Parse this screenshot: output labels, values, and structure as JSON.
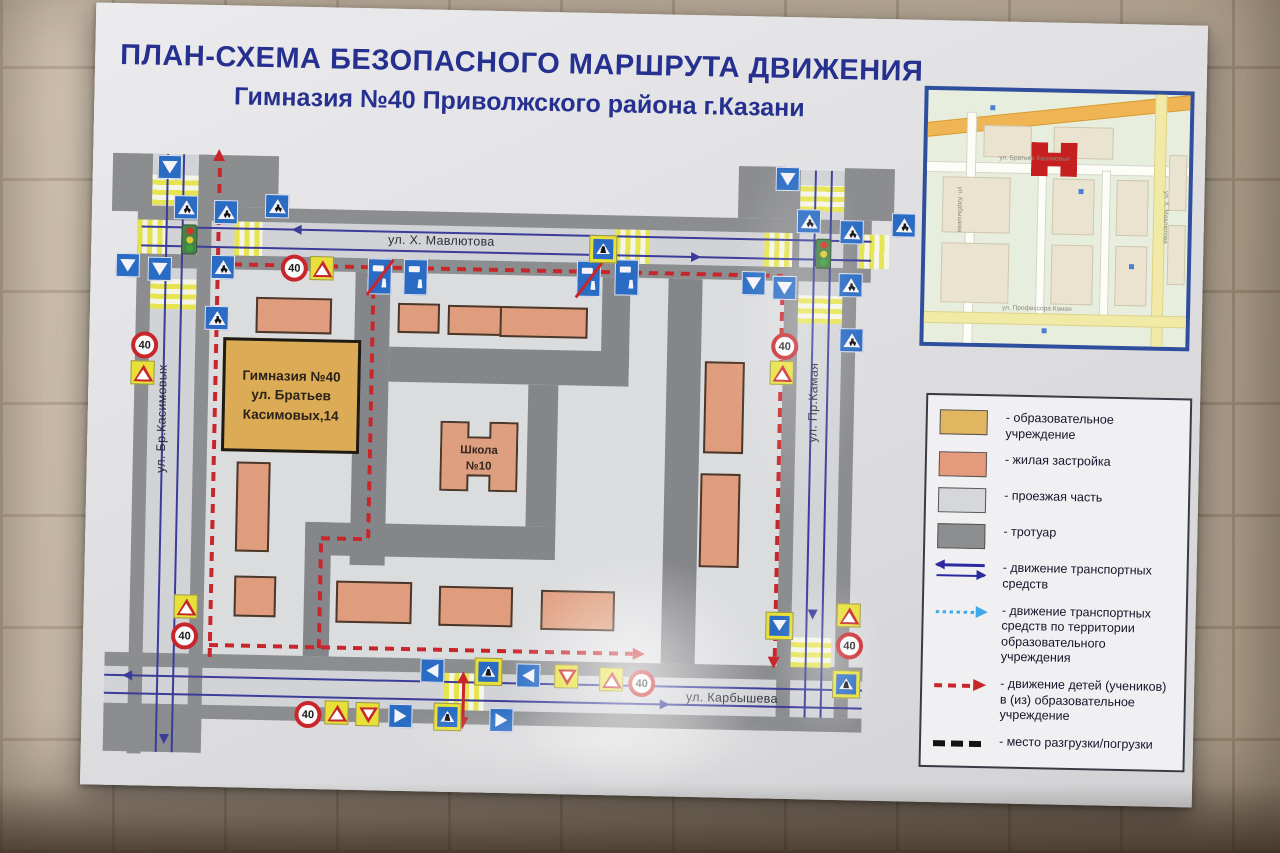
{
  "title": {
    "line1": "ПЛАН-СХЕМА БЕЗОПАСНОГО МАРШРУТА ДВИЖЕНИЯ",
    "line2": "Гимназия №40 Приволжского района г.Казани"
  },
  "streets": {
    "top": "ул. Х. Мавлютова",
    "left": "ул. Бр.Касимовых",
    "right": "ул. Пр.Камая",
    "bottom": "ул. Карбышева"
  },
  "buildings": {
    "gymnasium": {
      "line1": "Гимназия №40",
      "line2": "ул. Братьев",
      "line3": "Касимовых,14"
    },
    "school": {
      "line1": "Школа",
      "line2": "№10"
    }
  },
  "signs": {
    "speed_limit": "40"
  },
  "inset": {
    "street_top": "ул. Братьев Касимовых",
    "street_bottom": "ул. Профессора Камая",
    "street_left": "ул. Карбышева",
    "street_right": "ул. Х. Мавлютова"
  },
  "legend": {
    "items": [
      {
        "label": "- образовательное учреждение",
        "swatch": "#e2b561"
      },
      {
        "label": "- жилая застройка",
        "swatch": "#e59b7b"
      },
      {
        "label": "- проезжая часть",
        "swatch": "#d6d7db"
      },
      {
        "label": "- тротуар",
        "swatch": "#8d8e90"
      },
      {
        "label": "- движение транспортных средств",
        "swatch": "arrows-blue"
      },
      {
        "label": "- движение транспортных средств по территории образовательного учреждения",
        "swatch": "arrow-dotted-lightblue"
      },
      {
        "label": "- движение детей (учеников) в (из) образовательное учреждение",
        "swatch": "arrow-dashed-red"
      },
      {
        "label": "- место разгрузки/погрузки",
        "swatch": "dashes-black"
      }
    ]
  },
  "colors": {
    "title_blue": "#26308f",
    "route_red": "#c8262b",
    "lane_blue": "#3b3d99",
    "sign_blue": "#2a6cc4",
    "sign_yellow": "#e8df39",
    "education": "#dcab55",
    "residential": "#df9d7d",
    "roadway": "#d2d3d6",
    "sidewalk": "#8c8d8f"
  }
}
